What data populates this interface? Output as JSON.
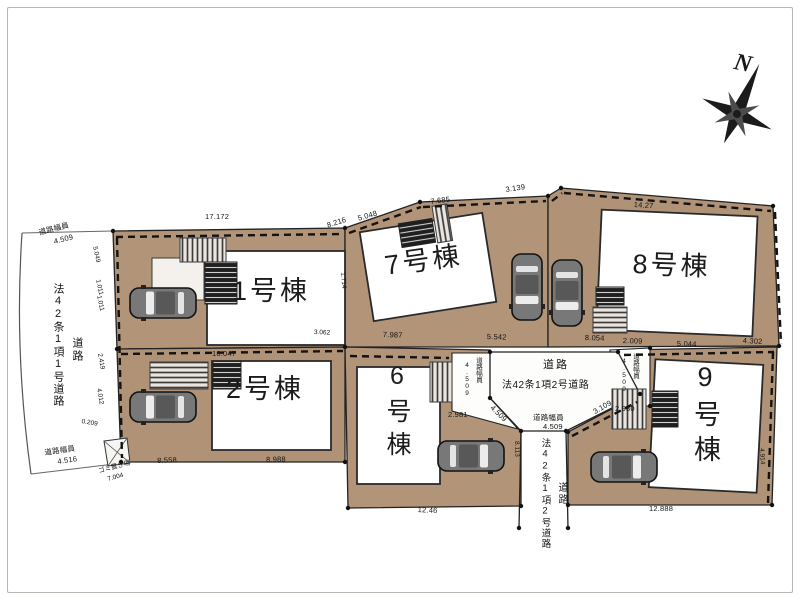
{
  "compass": {
    "label": "N"
  },
  "icons": {
    "compass": "compass-rose-icon",
    "car": "car-top-view-icon",
    "steps": "entrance-steps-hatch"
  },
  "colors": {
    "lot_fill": "#b29478",
    "road_fill": "#fdfdfb",
    "line": "#1c1c1c"
  },
  "buildings": {
    "b1": {
      "label": "1号棟"
    },
    "b2": {
      "label": "2号棟"
    },
    "b6": {
      "label": "6号棟"
    },
    "b7": {
      "label": "7号棟"
    },
    "b8": {
      "label": "8号棟"
    },
    "b9": {
      "label": "9号棟"
    }
  },
  "roads": {
    "west": {
      "name": "道路",
      "classification": "法42条1項1号道路",
      "width_top_label": "道路幅員",
      "width_top_value": "4.509",
      "width_bottom_label": "道路幅員",
      "width_bottom_value": "4.516"
    },
    "center": {
      "name": "道路",
      "classification": "法42条1項2号道路",
      "width_label": "道路幅員",
      "width_value": "4.509"
    },
    "south": {
      "name": "道路",
      "classification": "法42条1項2号道路"
    },
    "corner_west": {
      "label": "道路幅員",
      "value": "4.509"
    },
    "corner_east": {
      "label": "道路幅員",
      "value": "4.509"
    }
  },
  "garbage_area": {
    "label": "ゴミ置き場",
    "value": "7.004"
  },
  "dimensions": {
    "d0": "17.172",
    "d1": "8.216",
    "d2": "5.048",
    "d3": "7.685",
    "d4": "3.139",
    "d5": "14.27",
    "d6": "16.047",
    "d7": "8.558",
    "d8": "8.988",
    "d9": "7.987",
    "d10": "5.542",
    "d11": "8.054",
    "d12": "2.009",
    "d13": "5.044",
    "d14": "4.302",
    "d15": "2.981",
    "d16": "2.980",
    "d17": "12.46",
    "d18": "12.888",
    "d19": "4.509",
    "d20": "3.109",
    "d21": "8.113",
    "d22": "5.049",
    "d23": "1.011",
    "d24": "1.011",
    "d25": "2.419",
    "d26": "4.012",
    "d27": "0.209",
    "d28": "1.714",
    "d29": "3.062",
    "d30": "4.914"
  }
}
